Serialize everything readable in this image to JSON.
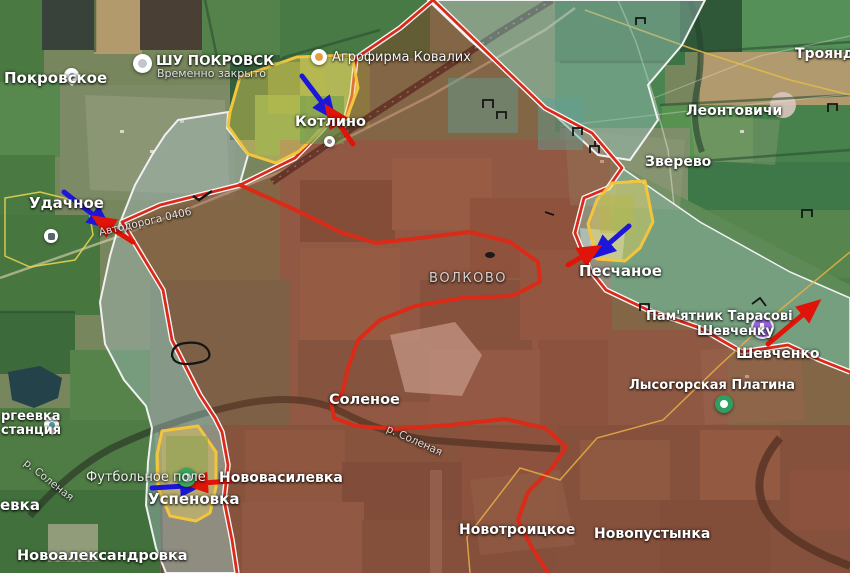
{
  "map": {
    "labels": {
      "pokrovskoe": "Покровское",
      "shu_pokrovsk": "ШУ ПОКРОВСК",
      "shu_pokrovsk_sub": "Временно закрыто",
      "agrofirma": "Агрофирма Ковалих",
      "kotlino": "Котлино",
      "troyanda": "Троянда",
      "leontovichi": "Леонтовичи",
      "zverevo": "Зверево",
      "udachnoe": "Удачное",
      "road_0406": "Автодорога 0406",
      "volkovo": "ВОЛКОВО",
      "peschanoe": "Песчаное",
      "pamyatnik_line1": "Пам'ятник Тарасові",
      "pamyatnik_line2": "Шевченку",
      "shevchenko": "Шевченко",
      "lysogorskaya": "Лысогорская Платина",
      "solenoe": "Соленое",
      "river_solenaya_1": "р. Соленая",
      "river_solenaya_2": "р. Соленая",
      "futbolnoe_pole": "Футбольное поле",
      "uspenovka": "Успеновка",
      "novovasilevka": "Нововасилевка",
      "novoaleksandrovka": "Новоалександровка",
      "novotroitskoe": "Новотроицкое",
      "novopustynka": "Новопустынка",
      "sergeevka_line1": "ргеевка",
      "sergeevka_line2": "станция",
      "evka_partial": "евка"
    },
    "icons": {
      "pokrovskoe_pin": "map-pin",
      "sergeevka_pin": "map-pin",
      "shu_pokrovsk_pin": "place-circle",
      "agrofirma_pin": "business-circle",
      "kotlino_dot": "station-dot",
      "udachnoe_poi": "poi-square",
      "pamyatnik_pin": "monument-circle",
      "lysogorskaya_poi": "park-circle",
      "futbolnoe_poi": "sports-field-circle"
    },
    "colors": {
      "occupied_fill": "rgba(155,35,25,0.33)",
      "frontline_red": "#d92a1a",
      "frontline_white": "#f8f8f8",
      "contested_yellow_fill": "rgba(235,215,90,0.42)",
      "contested_yellow_border": "#f2c53d",
      "gray_zone_fill": "rgba(168,188,196,0.42)",
      "teal_zone_fill": "rgba(150,188,182,0.45)",
      "arrow_blue": "#1b16d9",
      "arrow_red": "#e01408"
    },
    "zones": [
      {
        "id": "red-occupied-zone",
        "border": "red-with-white-outline"
      },
      {
        "id": "gray-contested-corridor",
        "border": "white"
      },
      {
        "id": "teal-zone-northeast",
        "border": "white"
      },
      {
        "id": "teal-band-shevchenko",
        "border": "white"
      },
      {
        "id": "yellow-pocket-kotlino",
        "border": "yellow"
      },
      {
        "id": "yellow-pocket-peschanoe",
        "border": "yellow"
      },
      {
        "id": "yellow-pocket-uspenovka",
        "border": "yellow"
      }
    ],
    "arrows": [
      {
        "id": "kotlino-blue",
        "color": "blue"
      },
      {
        "id": "kotlino-red",
        "color": "red"
      },
      {
        "id": "udachnoe-blue",
        "color": "blue"
      },
      {
        "id": "udachnoe-red",
        "color": "red"
      },
      {
        "id": "peschanoe-blue",
        "color": "blue"
      },
      {
        "id": "peschanoe-red",
        "color": "red"
      },
      {
        "id": "shevchenko-red",
        "color": "red"
      },
      {
        "id": "uspenovka-blue",
        "color": "blue"
      },
      {
        "id": "uspenovka-red",
        "color": "red"
      }
    ]
  }
}
